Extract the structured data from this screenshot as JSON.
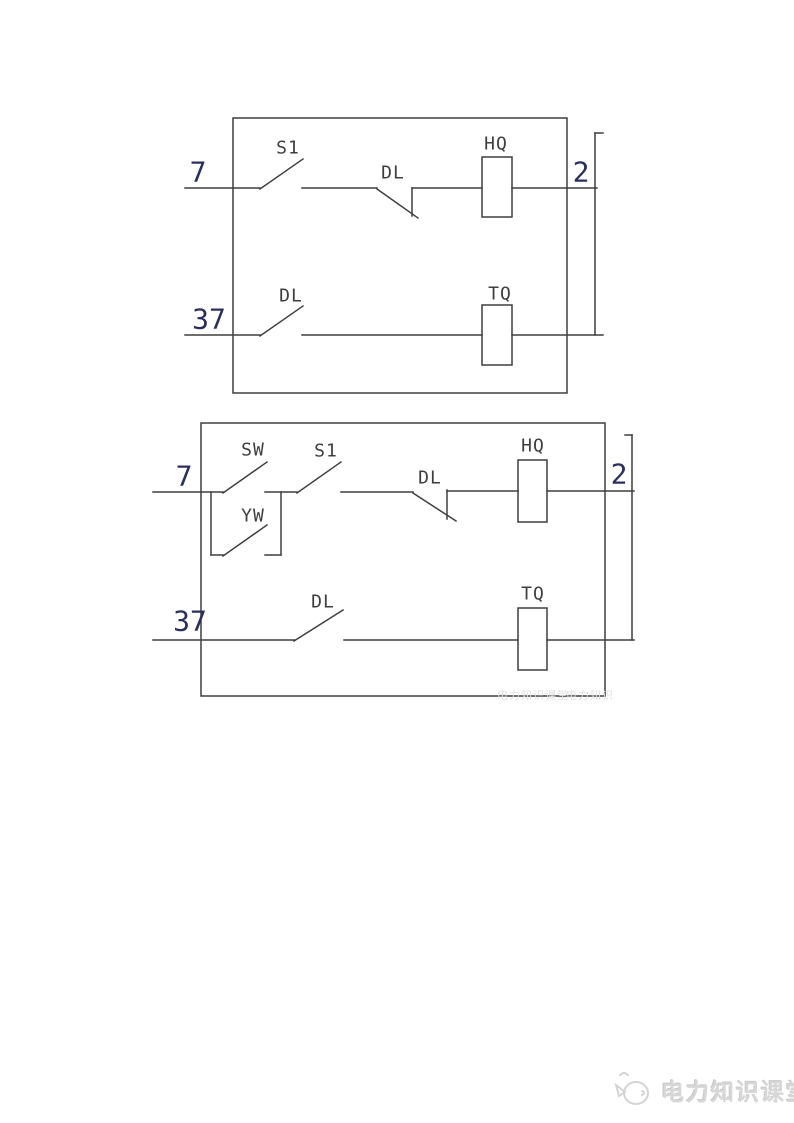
{
  "colors": {
    "line": "#3f3f3f",
    "label_text": "#3e3e3e",
    "terminal_text": "#2b2f5e",
    "watermark": "#e1e1e1",
    "brand_gray": "#d7d7d7",
    "background": "#ffffff"
  },
  "diagram1": {
    "terminal_left_top": "7",
    "terminal_left_bottom": "37",
    "terminal_right": "2",
    "switch_s1": "S1",
    "contact_dl_top": "DL",
    "coil_hq": "HQ",
    "contact_dl_bottom": "DL",
    "coil_tq": "TQ"
  },
  "diagram2": {
    "terminal_left_top": "7",
    "terminal_left_bottom": "37",
    "terminal_right": "2",
    "switch_sw": "SW",
    "switch_s1": "S1",
    "switch_yw": "YW",
    "contact_dl_top": "DL",
    "coil_hq": "HQ",
    "contact_dl_bottom": "DL",
    "coil_tq": "TQ"
  },
  "watermark": {
    "text": "电力知识课堂"
  },
  "footer": {
    "brand": "电力知识课堂"
  }
}
